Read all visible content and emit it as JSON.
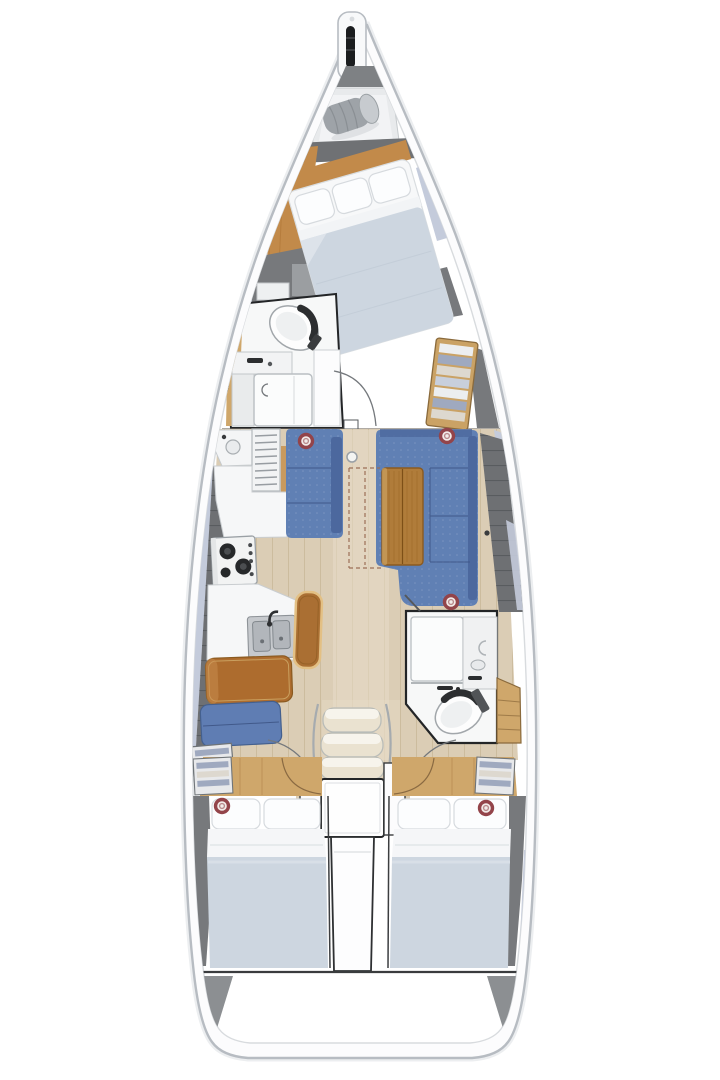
{
  "diagram": {
    "type": "boat-floor-plan",
    "subject": "sailing-yacht-interior-top-view",
    "areas": [
      {
        "id": "bowsprit",
        "name": "bow fitting with anchor roller"
      },
      {
        "id": "anchor-locker",
        "name": "anchor locker with stowed roll"
      },
      {
        "id": "forward-cabin",
        "name": "forward owner cabin with angled double berth"
      },
      {
        "id": "forward-head",
        "name": "forward bathroom with toilet, vanity and shower"
      },
      {
        "id": "galley",
        "name": "port galley with fridge, stove and double sink"
      },
      {
        "id": "salon",
        "name": "salon with port settee and starboard C-shaped dinette with folded table"
      },
      {
        "id": "nav-seat",
        "name": "port leather bench and blue bench"
      },
      {
        "id": "aft-head",
        "name": "aft bathroom with shower, vanity and toilet"
      },
      {
        "id": "companionway",
        "name": "companionway steps and engine box"
      },
      {
        "id": "aft-cabin-port",
        "name": "port aft double cabin"
      },
      {
        "id": "aft-cabin-starboard",
        "name": "starboard aft double cabin"
      },
      {
        "id": "transom",
        "name": "stern transom"
      }
    ],
    "deck_hatches": 5,
    "berths": 3
  },
  "palette": {
    "hull_line": "#b7bcc2",
    "hull_inner_line": "#d8dbde",
    "hull_shadow": "#eceef0",
    "deck_white": "#fcfcfd",
    "trim_black": "#232527",
    "walkway": "#6e7073",
    "walkway_line": "#56585b",
    "sidedeck": "#c4cbdb",
    "dark_panel": "#77797c",
    "dark_panel_light": "#9b9ea1",
    "wood_floor": "#dbcdb5",
    "wood_floor_line": "#b9a583",
    "aisle": "#e8ddc9",
    "wood_warm": "#c28a4a",
    "wood_warm_line": "#a96f2f",
    "wood_cabinet": "#cfa76b",
    "wood_cabinet_line": "#b18449",
    "wood_table": "#b07c3a",
    "wood_table_line": "#8a5a20",
    "stool": "#aa6f33",
    "stool_edge": "#e3c084",
    "leather": "#ad6c2e",
    "leather_edge": "#8a5a20",
    "sofa": "#6080b4",
    "sofa_dark": "#4c689e",
    "sofa_seam": "#41598a",
    "bench_blue": "#5f7db3",
    "duvet": "#cdd6e0",
    "duvet_light": "#dde3ea",
    "sheet": "#f5f6f8",
    "pillow": "#fcfdfe",
    "pillow_line": "#d6dade",
    "fixture": "#f7f8f8",
    "fixture_line": "#aab0b5",
    "steel": "#c6c9cd",
    "burner": "#26282a",
    "hatch_ring": "#93444a",
    "hatch_fill": "#f3ecea",
    "arc": "#74787c",
    "dash": "#9b6f57",
    "stripe_light": "#eceef0",
    "stripe_blue": "#9fa9bf",
    "stripe_tan": "#ddd8cf",
    "stern_gray": "#8c8f92"
  }
}
